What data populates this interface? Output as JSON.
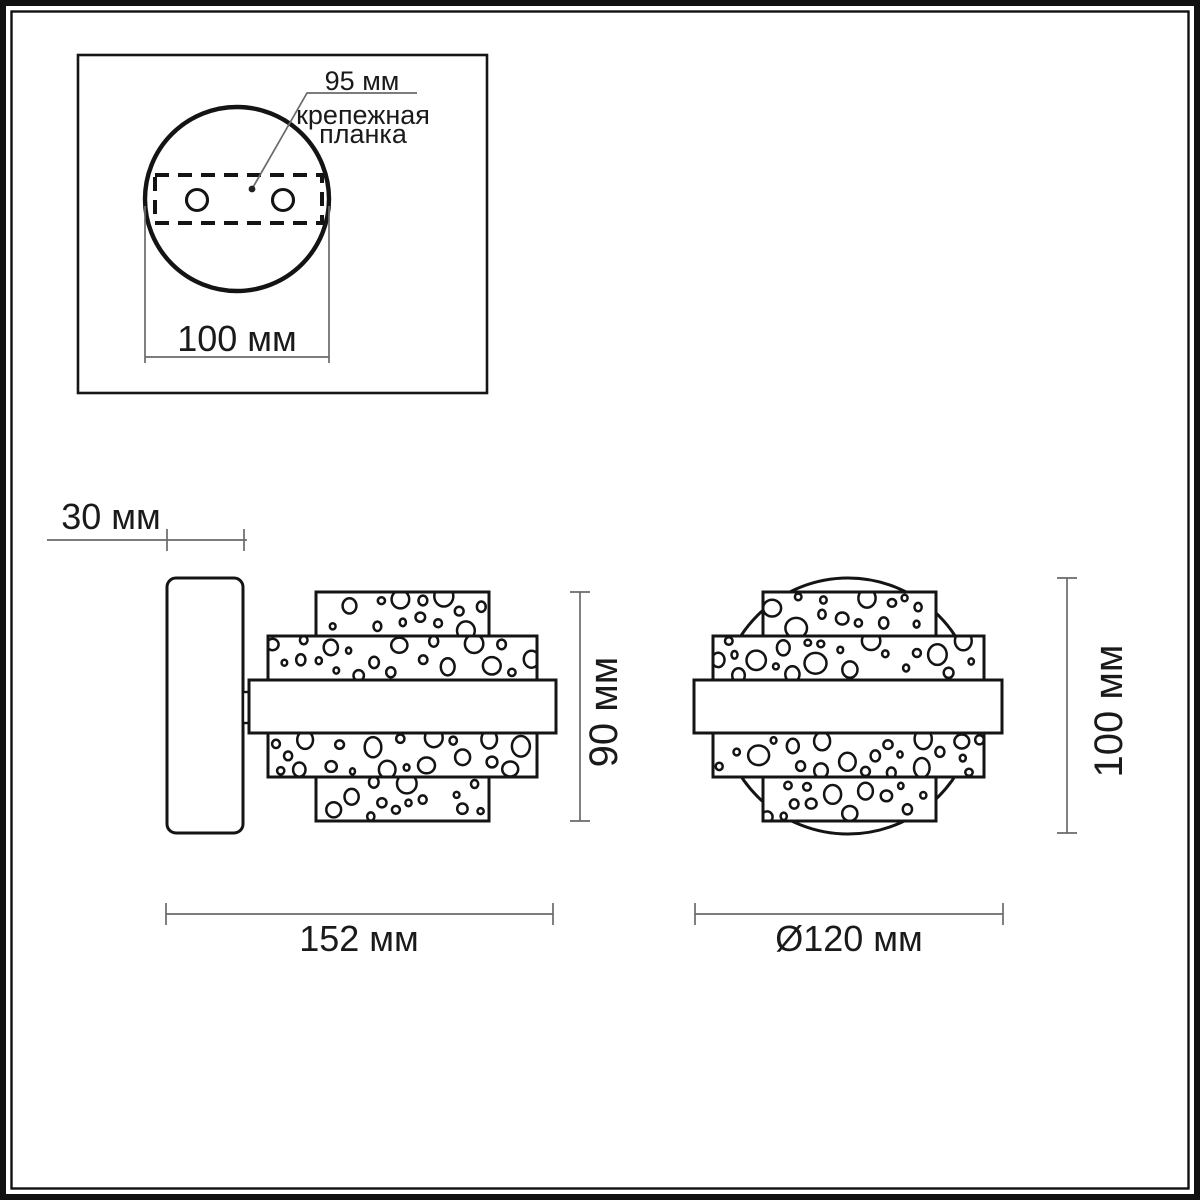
{
  "inset": {
    "bracket_spacing": "95 мм",
    "bracket_name_line1": "крепежная",
    "bracket_name_line2": "планка",
    "base_width": "100 мм"
  },
  "side_view": {
    "depth": "30 мм",
    "height": "90 мм",
    "width": "152 мм"
  },
  "front_view": {
    "height": "100 мм",
    "diameter": "Ø120 мм"
  },
  "colors": {
    "line": "#141414",
    "dim_line": "#6a6a6a",
    "text": "#1a1a1a",
    "background": "#ffffff"
  }
}
